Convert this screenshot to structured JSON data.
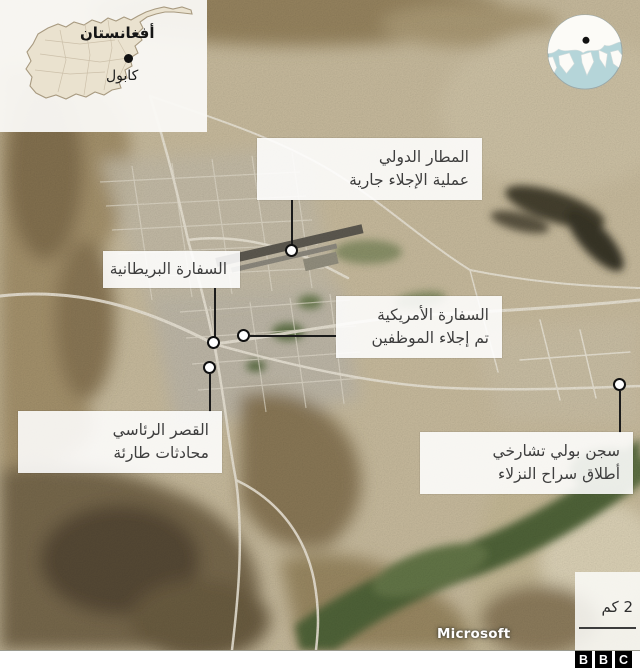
{
  "inset": {
    "country": "أفغانستان",
    "city": "كابول"
  },
  "callouts": [
    {
      "id": "airport",
      "title": "المطار الدولي",
      "subtitle": "عملية الإجلاء جارية"
    },
    {
      "id": "british-embassy",
      "title": "السفارة البريطانية",
      "subtitle": ""
    },
    {
      "id": "us-embassy",
      "title": "السفارة الأمريكية",
      "subtitle": "تم إجلاء الموظفين"
    },
    {
      "id": "presidential-palace",
      "title": "القصر الرئاسي",
      "subtitle": "محادثات طارئة"
    },
    {
      "id": "prison",
      "title": "سجن بولي تشارخي",
      "subtitle": "أطلاق سراح النزلاء"
    }
  ],
  "scale": {
    "label": "2 كم"
  },
  "attribution": {
    "text": "Microsoft"
  },
  "logo": {
    "letters": [
      "B",
      "B",
      "C"
    ]
  },
  "colors": {
    "label_background": "#ffffff",
    "label_text": "#3e3e3e",
    "connector": "#1b1b1b",
    "globe_ocean": "#b5d5d9",
    "inset_country_fill": "#eae2cf",
    "terrain_base": "#c9bc9e"
  }
}
